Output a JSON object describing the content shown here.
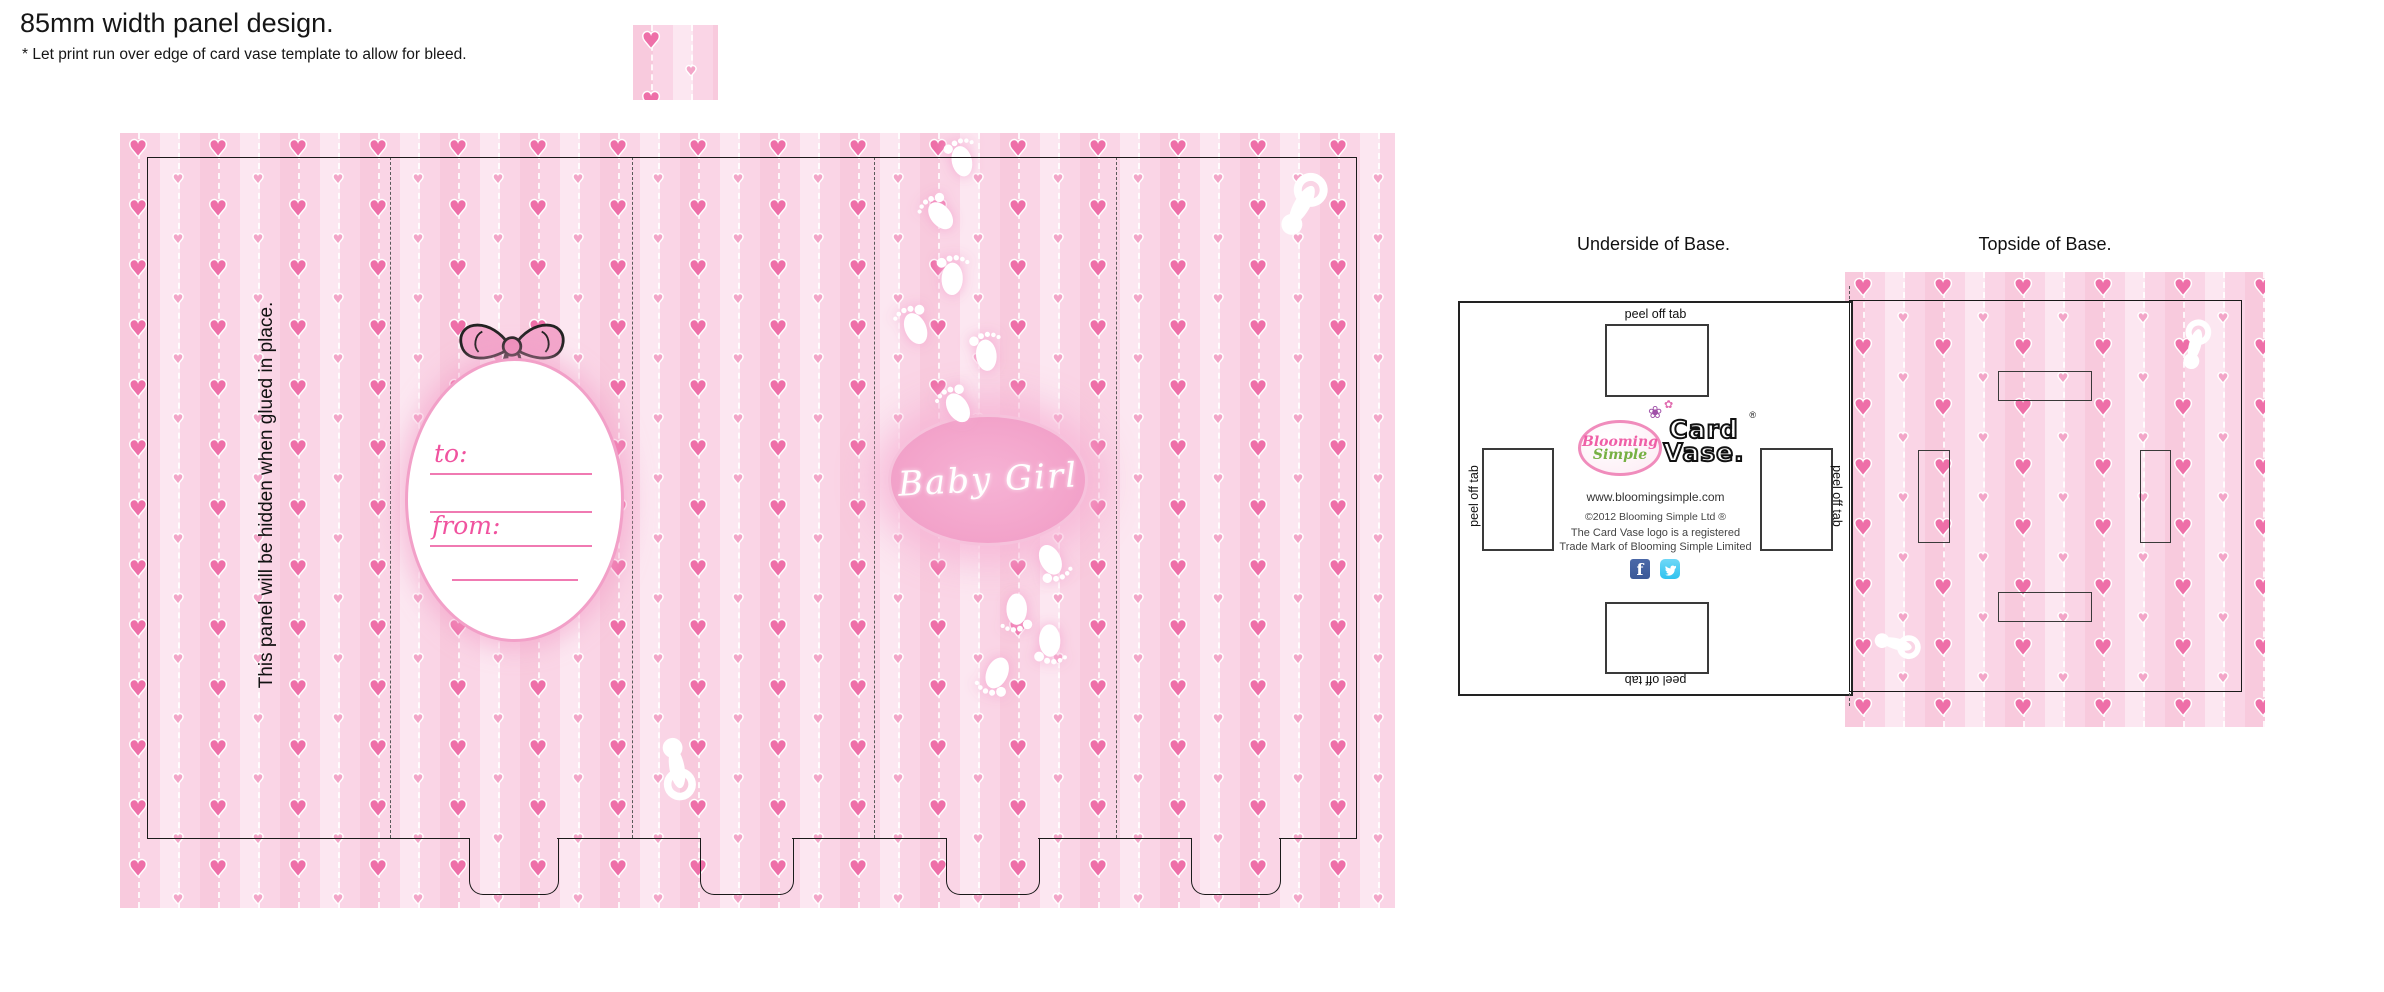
{
  "header": {
    "title": "85mm width panel design.",
    "subtitle": "* Let print run over edge of card vase template to allow for bleed."
  },
  "main_panel": {
    "glue_note": "This panel will be hidden when glued in place.",
    "tag": {
      "to": "to:",
      "from": "from:"
    },
    "badge": "Baby Girl"
  },
  "bases": {
    "underside_title": "Underside of Base.",
    "topside_title": "Topside of Base.",
    "peel_off_tab": "peel off tab",
    "branding": {
      "logo_word1": "Blooming",
      "logo_word2": "Simple",
      "cardvase_word1": "Card",
      "cardvase_word2": "Vase.",
      "registered_mark": "®",
      "website": "www.bloomingsimple.com",
      "copyright": "©2012 Blooming Simple Ltd ®",
      "trademark_line1": "The Card Vase logo is a registered",
      "trademark_line2": "Trade Mark of Blooming Simple Limited",
      "social": [
        "facebook",
        "twitter"
      ]
    }
  },
  "colors": {
    "stripe_light": "#fce7f1",
    "stripe_mid": "#fad5e6",
    "stripe_dark": "#f8cadd",
    "heart_big": "#ee6fa8",
    "heart_small": "#f3a5c8",
    "badge_pink": "#f2a0c8",
    "script_pink": "#f0539f",
    "bow_pink": "#f3a6cb",
    "logo_pink": "#ef5fa7",
    "logo_green": "#76b043",
    "facebook_blue": "#3b5998",
    "twitter_blue": "#2fc2ef",
    "cut_line": "#1a1a1a",
    "fold_line": "#5a5a5a"
  }
}
